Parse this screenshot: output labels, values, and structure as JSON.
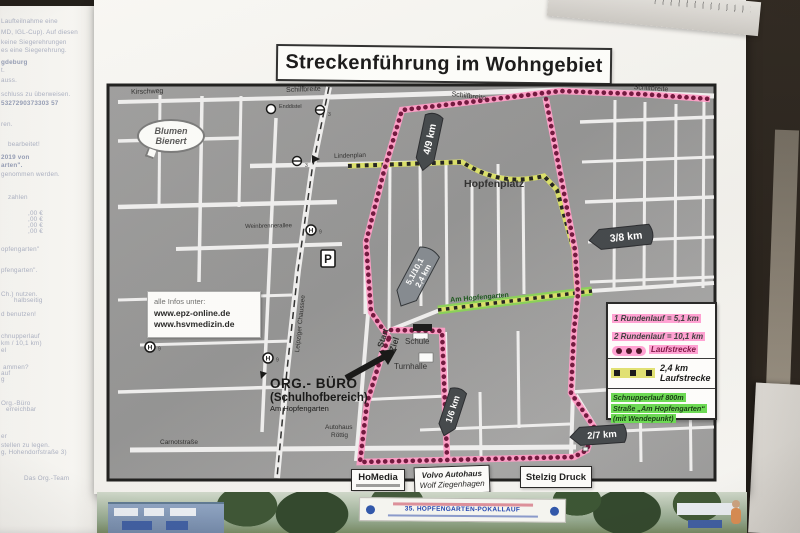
{
  "poster": {
    "title": "Streckenführung im Wohngebiet",
    "map": {
      "markers": {
        "k49": "4/9 km",
        "k38": "3/8 km",
        "k16": "1/6 km",
        "k27": "2/7 km",
        "dist1": "5,1/10,1",
        "dist2": "2,4 km"
      },
      "icons": {
        "h": "H",
        "p": "P",
        "n3": "3",
        "n9": "9"
      },
      "bubble": {
        "l1": "Blumen",
        "l2": "Bienert"
      },
      "info": {
        "l1": "alle Infos unter:",
        "l2": "www.epz-online.de",
        "l3": "www.hsvmedizin.de"
      },
      "org": {
        "l1": "ORG.- BÜRO",
        "l2": "(Schulhofbereich)",
        "l3": "Am Hopfengarten"
      },
      "street_labels": [
        {
          "t": "Kirschweg",
          "x": 131,
          "y": 89,
          "s": 7,
          "r": -2
        },
        {
          "t": "Schilfbreite",
          "x": 286,
          "y": 87,
          "s": 7,
          "r": -2
        },
        {
          "t": "Schilfbreite",
          "x": 452,
          "y": 91,
          "s": 7,
          "r": 7
        },
        {
          "t": "Schilfbreite",
          "x": 634,
          "y": 84,
          "s": 7,
          "r": 4
        },
        {
          "t": "Enddistel",
          "x": 279,
          "y": 105,
          "s": 5.5,
          "r": 0
        },
        {
          "t": "Lindenplan",
          "x": 334,
          "y": 154,
          "s": 6.5,
          "r": -2
        },
        {
          "t": "Hopfenplatz",
          "x": 464,
          "y": 179,
          "s": 10.5,
          "r": 0,
          "b": 1
        },
        {
          "t": "Weinbrennerallee",
          "x": 245,
          "y": 224,
          "s": 6,
          "r": -1
        },
        {
          "t": "Leipziger Chaussee",
          "x": 295,
          "y": 352,
          "s": 6.5,
          "r": -84
        },
        {
          "t": "Am Hopfengarten",
          "x": 450,
          "y": 297,
          "s": 7,
          "r": -5,
          "c": "#175418",
          "b": 1
        },
        {
          "t": "Carnotstraße",
          "x": 160,
          "y": 440,
          "s": 6.5,
          "r": 0
        },
        {
          "t": "Schule",
          "x": 405,
          "y": 338,
          "s": 8,
          "r": 0
        },
        {
          "t": "Turnhalle",
          "x": 394,
          "y": 363,
          "s": 8,
          "r": 0
        },
        {
          "t": "Autohaus",
          "x": 325,
          "y": 425,
          "s": 6.5,
          "r": 0
        },
        {
          "t": "Röttig",
          "x": 331,
          "y": 433,
          "s": 6.5,
          "r": 0
        },
        {
          "t": "Start",
          "x": 376,
          "y": 346,
          "s": 8.5,
          "r": -72,
          "b": 1
        },
        {
          "t": "Ziel",
          "x": 388,
          "y": 350,
          "s": 8.5,
          "r": -72,
          "b": 1
        }
      ],
      "colors": {
        "route_pink": "#ff9ac5",
        "route_dot": "#6e1139",
        "route_yellow": "#d8de66",
        "route_dash_black": "#1d1d1d",
        "schnupper_green": "#86cf55"
      }
    },
    "legend": {
      "line1": "1 Rundenlauf = 5,1 km",
      "line2": "2 Rundenlauf = 10,1 km",
      "dots_label": "Laufstrecke",
      "row2_km": "2,4 km",
      "row2_label": "Laufstrecke",
      "row3": [
        "Schnupperlauf 800m",
        "Straße „Am Hopfengarten“",
        "(mit Wendepunkt)"
      ]
    },
    "sponsors": {
      "s1": "HoMedia",
      "s2a": "Volvo Autohaus",
      "s2b": "Wolf Ziegenhagen",
      "s3": "Stelzig Druck"
    },
    "photo_strip": {
      "banner_title": "35. HOPFENGARTEN-POKALLAUF"
    }
  },
  "left_paper": {
    "lines": [
      {
        "t": "Laufteilnahme eine",
        "x": 1,
        "y": 18
      },
      {
        "t": "MD, IGL-Cup). Auf diesen",
        "x": 1,
        "y": 29
      },
      {
        "t": "keine Siegerehrungen",
        "x": 1,
        "y": 39
      },
      {
        "t": "es eine Siegerehrung.",
        "x": 1,
        "y": 47
      },
      {
        "t": "gdeburg",
        "x": 1,
        "y": 59,
        "b": 1
      },
      {
        "t": "t.",
        "x": 1,
        "y": 67
      },
      {
        "t": "auss.",
        "x": 1,
        "y": 77
      },
      {
        "t": "schluss zu überweisen.",
        "x": 1,
        "y": 91
      },
      {
        "t": "5327290373303 57",
        "x": 1,
        "y": 100,
        "b": 1
      },
      {
        "t": "ren.",
        "x": 1,
        "y": 121
      },
      {
        "t": "bearbeitet!",
        "x": 8,
        "y": 141
      },
      {
        "t": "2019 von",
        "x": 1,
        "y": 154,
        "b": 1
      },
      {
        "t": "arten\".",
        "x": 1,
        "y": 162,
        "b": 1
      },
      {
        "t": "genommen werden.",
        "x": 1,
        "y": 171
      },
      {
        "t": "zahlen",
        "x": 8,
        "y": 194
      },
      {
        "t": ",00 €",
        "x": 28,
        "y": 210
      },
      {
        "t": ",00 €",
        "x": 28,
        "y": 216
      },
      {
        "t": ",00 €",
        "x": 28,
        "y": 222
      },
      {
        "t": ",00 €",
        "x": 28,
        "y": 228
      },
      {
        "t": "opfengarten\"",
        "x": 1,
        "y": 246
      },
      {
        "t": "pfengarten\".",
        "x": 1,
        "y": 267
      },
      {
        "t": "Ch.) nutzen.",
        "x": 1,
        "y": 291
      },
      {
        "t": "halbseitig",
        "x": 14,
        "y": 297
      },
      {
        "t": "d benutzen!",
        "x": 1,
        "y": 311
      },
      {
        "t": "chnupperlauf",
        "x": 1,
        "y": 333
      },
      {
        "t": "km / 10,1 km)",
        "x": 1,
        "y": 340
      },
      {
        "t": "el",
        "x": 1,
        "y": 347
      },
      {
        "t": "ammen?",
        "x": 3,
        "y": 364
      },
      {
        "t": "auf",
        "x": 1,
        "y": 370
      },
      {
        "t": "g",
        "x": 1,
        "y": 376
      },
      {
        "t": "Org.-Büro",
        "x": 1,
        "y": 400
      },
      {
        "t": "erreichbar",
        "x": 6,
        "y": 406
      },
      {
        "t": "er",
        "x": 1,
        "y": 433
      },
      {
        "t": "stellen zu legen.",
        "x": 1,
        "y": 442
      },
      {
        "t": "g, Hohendorfstraße 3)",
        "x": 1,
        "y": 449
      },
      {
        "t": "Das Org.-Team",
        "x": 24,
        "y": 475
      }
    ]
  }
}
